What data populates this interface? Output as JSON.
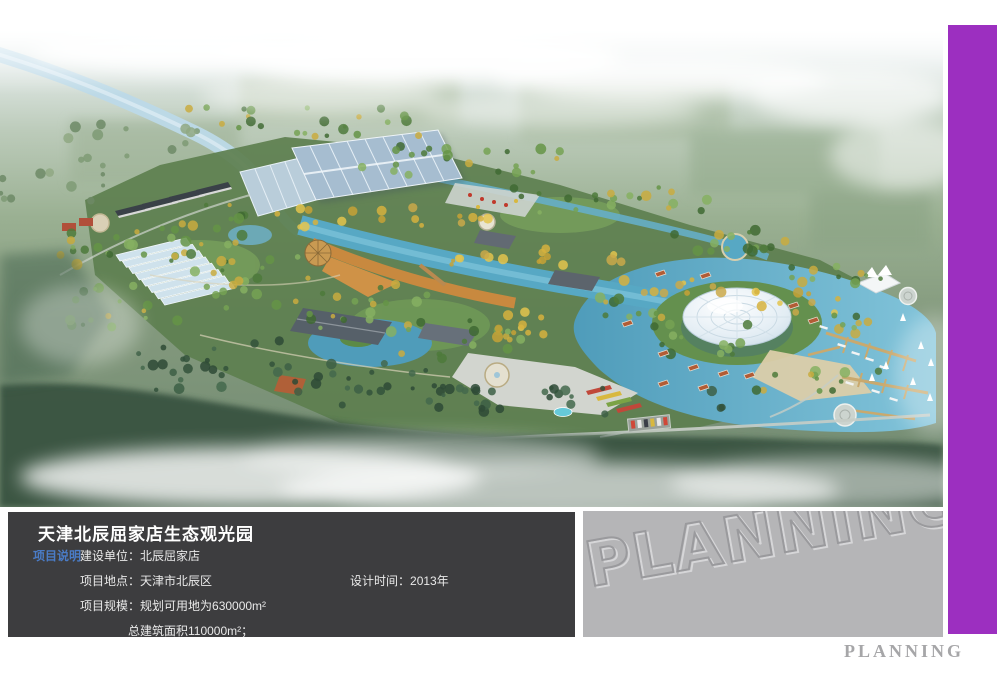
{
  "info_panel": {
    "title": "天津北辰屈家店生态观光园",
    "section_label": "项目说明",
    "rows": [
      {
        "label": "建设单位：",
        "value": "北辰屈家店"
      },
      {
        "label": "项目地点：",
        "value": "天津市北辰区",
        "label2": "设计时间：",
        "value2": "2013年"
      },
      {
        "label": "项目规模：",
        "value": "规划可用地为630000m²"
      },
      {
        "label": "",
        "value": "总建筑面积110000m²；"
      }
    ]
  },
  "watermark_panel": {
    "text": "PLANNING"
  },
  "footer": {
    "brand": "PLANNING"
  },
  "colors": {
    "accent_purple": "#9c2fc0",
    "info_panel_dark": "#3d3d3f",
    "watermark_gray": "#b5b5b7",
    "section_label_blue": "#4a7cc7"
  }
}
